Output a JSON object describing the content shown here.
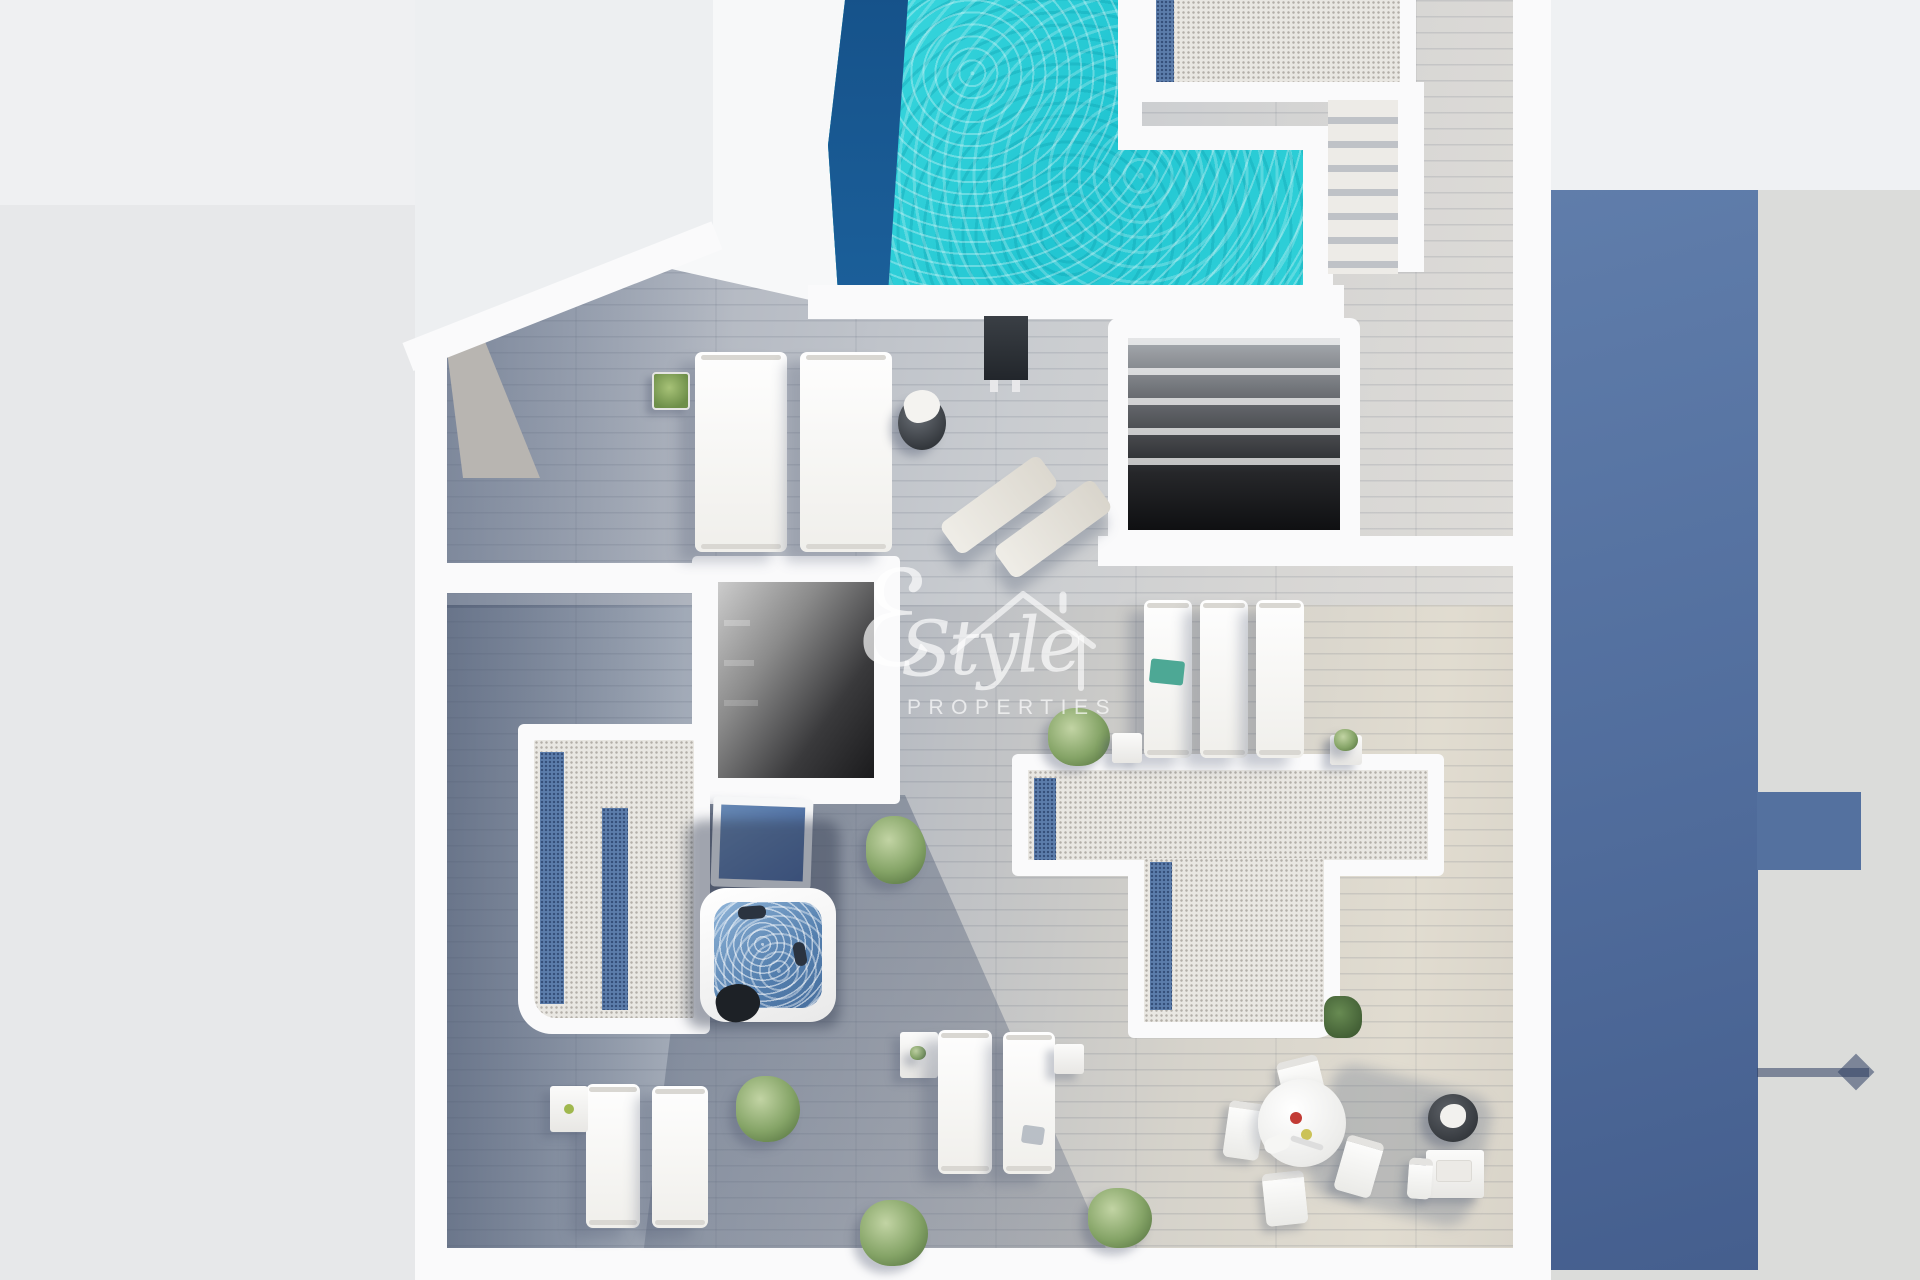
{
  "watermark": {
    "initial": "ℰ",
    "name": "Style",
    "tagline": "PROPERTIES",
    "icon": "house-roof-icon"
  },
  "palette": {
    "pool_water": "#2bd0d8",
    "pool_shadow": "#1a5a94",
    "jacuzzi_water": "#6795c5",
    "cast_shadow_blue": "#54719f",
    "gravel": "#e9e7e2",
    "gravel_blue": "#5c7dab",
    "wall_white": "#fafafb",
    "deck_shaded": "#8d99ac",
    "deck_light": "#d8d5cd",
    "lawn_green": "#4f6b3f"
  }
}
